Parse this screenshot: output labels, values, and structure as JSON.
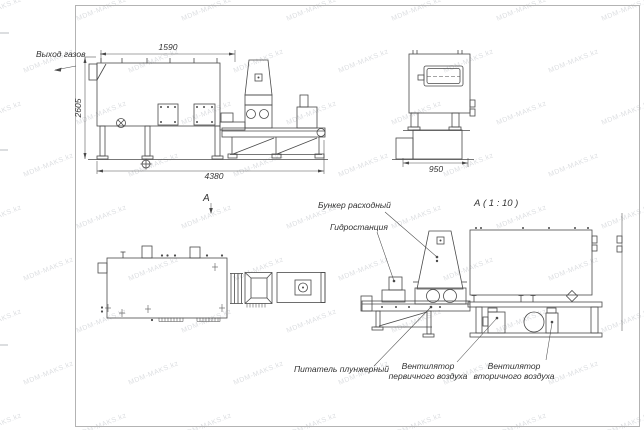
{
  "title": "Boiler unit assembly drawing",
  "watermark": {
    "text": "MDM-MAKS.kz"
  },
  "colors": {
    "line": "#4a4a4a",
    "label_text": "#333333",
    "frame": "#b3b3b3",
    "watermark": "rgba(140,145,155,0.30)"
  },
  "labels": {
    "gas_outlet": "Выход газов",
    "hopper": "Бункер расходный",
    "hydraulic_station": "Гидростанция",
    "plunger_feeder": "Питатель плунжерный",
    "primary_fan_line1": "Вентилятор",
    "primary_fan_line2": "первичного воздуха",
    "secondary_fan_line1": "Вентилятор",
    "secondary_fan_line2": "вторичного воздуха",
    "view_marker": "А",
    "detail_title": "А ( 1 : 10 )"
  },
  "dimensions": {
    "top_width": "1590",
    "overall_height": "2605",
    "overall_length": "4380",
    "end_width": "950"
  }
}
